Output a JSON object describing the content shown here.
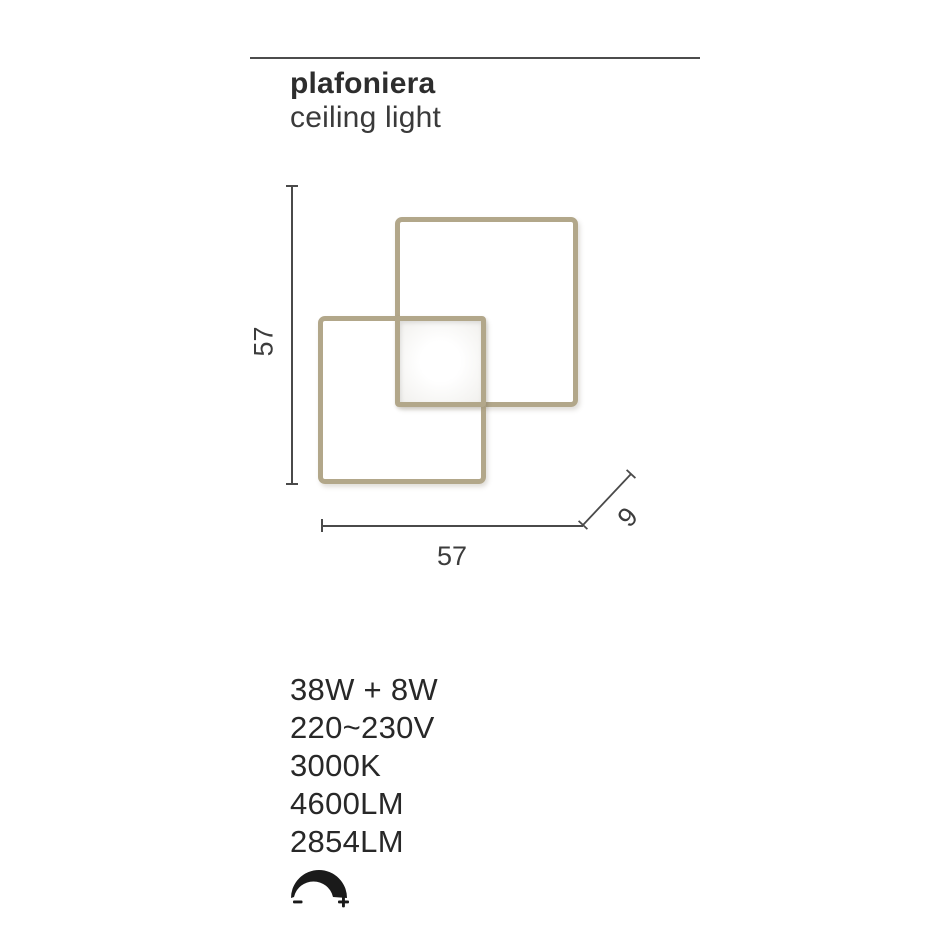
{
  "header": {
    "title": "plafoniera",
    "subtitle": "ceiling light"
  },
  "drawing": {
    "description_icon": "two-overlapping-square-led-frames",
    "frame_color": "#b2a78a",
    "panel_fill": "#f4f3f0"
  },
  "dimensions": {
    "height_label": "57",
    "width_label": "57",
    "depth_label": "9"
  },
  "specs": {
    "lines": [
      "38W + 8W",
      "220~230V",
      "3000K",
      "4600LM",
      "2854LM"
    ]
  },
  "dimmer": {
    "icon": "dimmable-arc-icon",
    "minus_label": "-",
    "plus_label": "+",
    "icon_color": "#1a1a1a"
  },
  "colors": {
    "background": "#ffffff",
    "text_dark": "#2b2b2b",
    "line_gray": "#4a4a4a"
  }
}
